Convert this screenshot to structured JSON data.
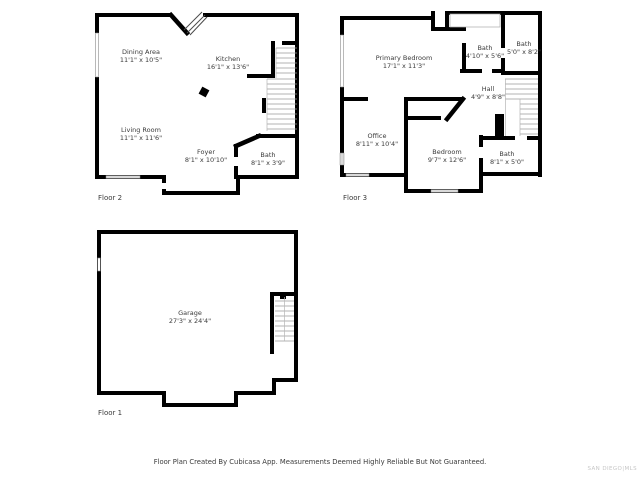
{
  "watermark": "SAN DIEGO|MLS",
  "footer": {
    "disclaimer": "Floor Plan Created By Cubicasa App. Measurements Deemed Highly Reliable But Not Guaranteed."
  },
  "colors": {
    "wall": "#000000",
    "window_fill": "#d9d9d9",
    "text": "#3a3a3a",
    "watermark": "#c6c6c6"
  },
  "floors": [
    {
      "label": "Floor 2",
      "rooms": [
        {
          "name": "Dining Area",
          "dims": "11'1\" x 10'5\""
        },
        {
          "name": "Kitchen",
          "dims": "16'1\" x 13'6\""
        },
        {
          "name": "Living Room",
          "dims": "11'1\" x 11'6\""
        },
        {
          "name": "Foyer",
          "dims": "8'1\" x 10'10\""
        },
        {
          "name": "Bath",
          "dims": "8'1\" x 3'9\""
        }
      ]
    },
    {
      "label": "Floor 3",
      "rooms": [
        {
          "name": "Primary Bedroom",
          "dims": "17'1\" x 11'3\""
        },
        {
          "name": "Bath",
          "dims": "4'10\" x 5'6\""
        },
        {
          "name": "Bath",
          "dims": "5'0\" x 8'2\""
        },
        {
          "name": "Hall",
          "dims": "4'9\" x 8'8\""
        },
        {
          "name": "Office",
          "dims": "8'11\" x 10'4\""
        },
        {
          "name": "Bedroom",
          "dims": "9'7\" x 12'6\""
        },
        {
          "name": "Bath",
          "dims": "8'1\" x 5'0\""
        }
      ]
    },
    {
      "label": "Floor 1",
      "rooms": [
        {
          "name": "Garage",
          "dims": "27'3\" x 24'4\""
        }
      ]
    }
  ]
}
